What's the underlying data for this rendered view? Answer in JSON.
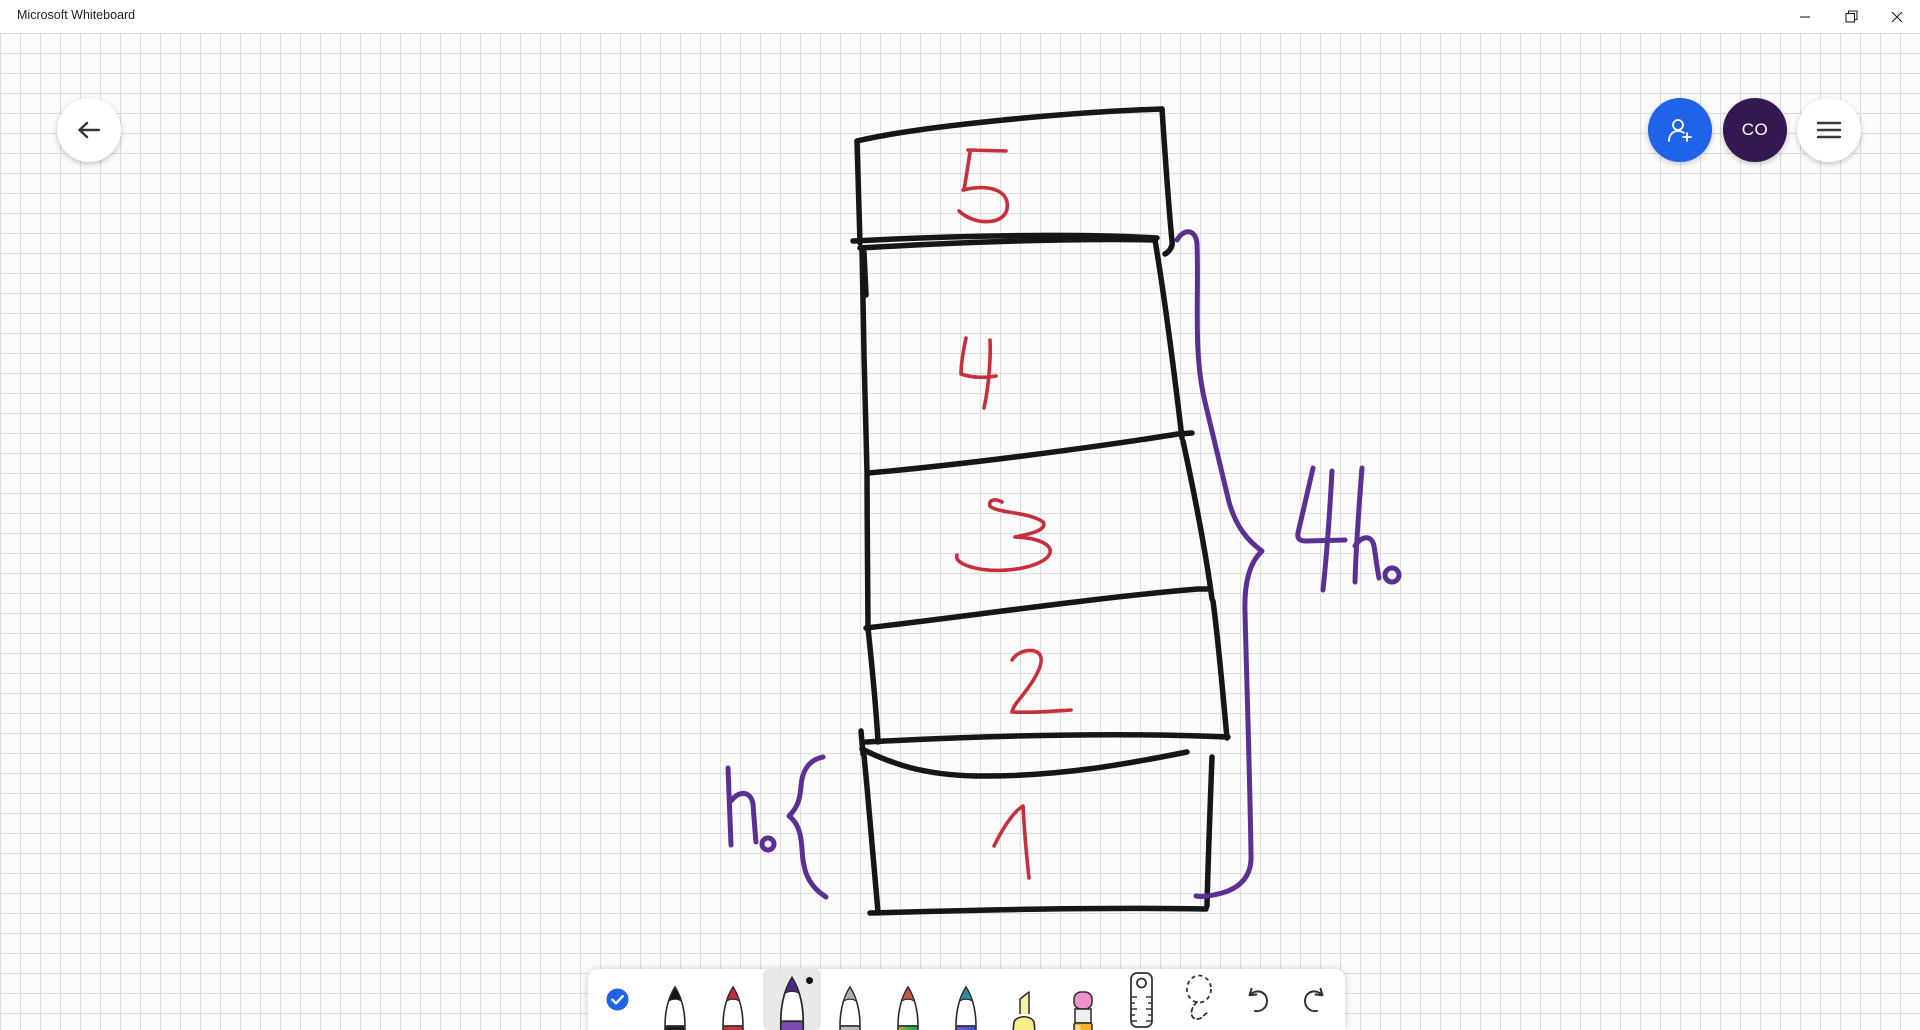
{
  "titlebar": {
    "title": "Microsoft Whiteboard",
    "window_controls": [
      "minimize",
      "restore",
      "close"
    ]
  },
  "topbar": {
    "back_button": "back-arrow",
    "invite_button": "person-add-icon",
    "avatar_initials": "CO",
    "menu_button": "hamburger-icon"
  },
  "toolbar": {
    "tools": [
      {
        "id": "check",
        "icon": "checkmark-circle",
        "selected": false
      },
      {
        "id": "pen-black",
        "icon": "pen",
        "color": "#161616",
        "selected": false
      },
      {
        "id": "pen-red",
        "icon": "pen",
        "color": "#d03434",
        "selected": false
      },
      {
        "id": "pen-purple",
        "icon": "pen",
        "color": "#7a4cb2",
        "selected": true
      },
      {
        "id": "pen-silver",
        "icon": "pen",
        "color": "#b9bdc2",
        "selected": false
      },
      {
        "id": "pen-rainbow",
        "icon": "pen",
        "color": "rainbow",
        "selected": false
      },
      {
        "id": "pen-galaxy",
        "icon": "pen",
        "color": "galaxy",
        "selected": false
      },
      {
        "id": "highlighter",
        "icon": "highlighter",
        "color": "#f6ef86",
        "selected": false
      },
      {
        "id": "eraser",
        "icon": "eraser",
        "selected": false
      },
      {
        "id": "ruler",
        "icon": "ruler",
        "selected": false
      },
      {
        "id": "lasso",
        "icon": "lasso-select",
        "selected": false
      },
      {
        "id": "undo",
        "icon": "undo-arrow",
        "selected": false
      },
      {
        "id": "redo",
        "icon": "redo-arrow",
        "selected": false
      }
    ]
  },
  "sketch": {
    "description": "hand-drawn stack of five boxes numbered bottom-to-top with height braces",
    "box_labels": [
      "5",
      "4",
      "3",
      "2",
      "1"
    ],
    "annotations": [
      {
        "text": "h₀",
        "side": "left",
        "spans": "box 1"
      },
      {
        "text": "4h₀",
        "side": "right",
        "spans": "boxes 1-4"
      }
    ],
    "ink_colors": {
      "boxes": "#161616",
      "numbers": "#c82f3c",
      "braces_labels": "#5b3093"
    }
  },
  "colors": {
    "accent_blue": "#2163e8",
    "avatar_bg": "#33194f",
    "ink_black": "#161616",
    "ink_red": "#c82f3c",
    "ink_purple": "#5b3093",
    "grid_line": "#dcdcdc",
    "canvas_bg": "#fbfbfb"
  }
}
